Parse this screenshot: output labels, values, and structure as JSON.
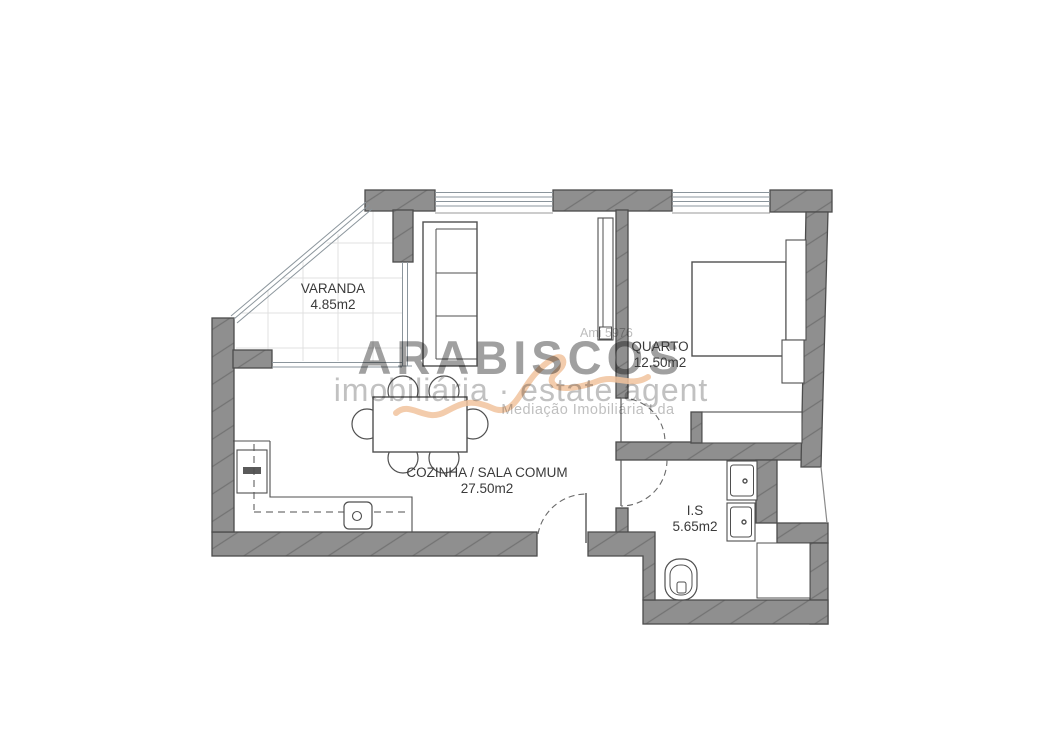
{
  "watermark": {
    "brand": "ARABISCOS",
    "tagline": "imobiliária · estate agent",
    "company": "Mediação Imobiliária Lda",
    "license": "Ami 5976"
  },
  "rooms": [
    {
      "name": "VARANDA",
      "area": "4.85m2"
    },
    {
      "name": "QUARTO",
      "area": "12.50m2"
    },
    {
      "name": "COZINHA / SALA COMUM",
      "area": "27.50m2"
    },
    {
      "name": "I.S",
      "area": "5.65m2"
    }
  ],
  "colors": {
    "wall": "#8f8f8f",
    "wall_hatch": "#737373",
    "wall_outline": "#4c4c4c",
    "label_text": "#3a3a3a",
    "watermark_gray": "#a0a0a0",
    "watermark_light": "#c1c1c1",
    "accent_squiggle": "#f1c39e",
    "window_glass": "#8b959c",
    "tile_grid": "#e0e0e0"
  },
  "fixtures": [
    "balcony-glazing",
    "window",
    "sofa",
    "shelf-unit",
    "dining-table",
    "chair",
    "fridge",
    "kitchen-counter",
    "kitchen-sink",
    "entrance-door",
    "bedroom-door",
    "bathroom-door",
    "bed",
    "nightstand",
    "wardrobe",
    "washbasin",
    "shower",
    "toilet"
  ]
}
